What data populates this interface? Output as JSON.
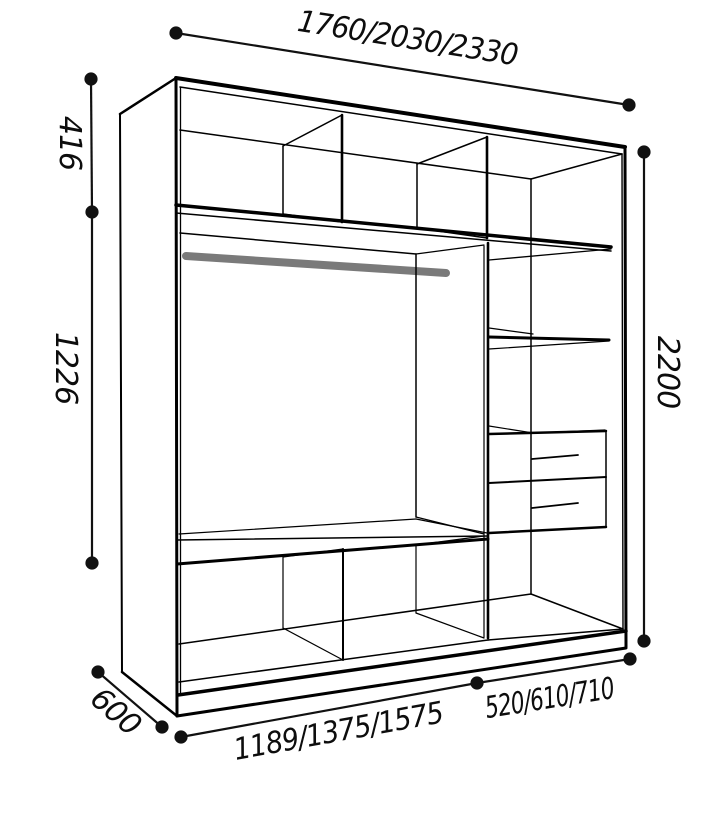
{
  "diagram_title": "Wardrobe interior dimension drawing",
  "dimensions": {
    "total_width_options": "1760/2030/2330",
    "top_section_height": "416",
    "hanging_section_height": "1226",
    "total_height": "2200",
    "depth": "600",
    "main_section_width_options": "1189/1375/1575",
    "side_section_width_options": "520/610/710"
  },
  "drawing": {
    "line_color": "#000000",
    "dimension_color": "#111111",
    "rod_color": "#7a7a7a",
    "background": "#ffffff"
  }
}
